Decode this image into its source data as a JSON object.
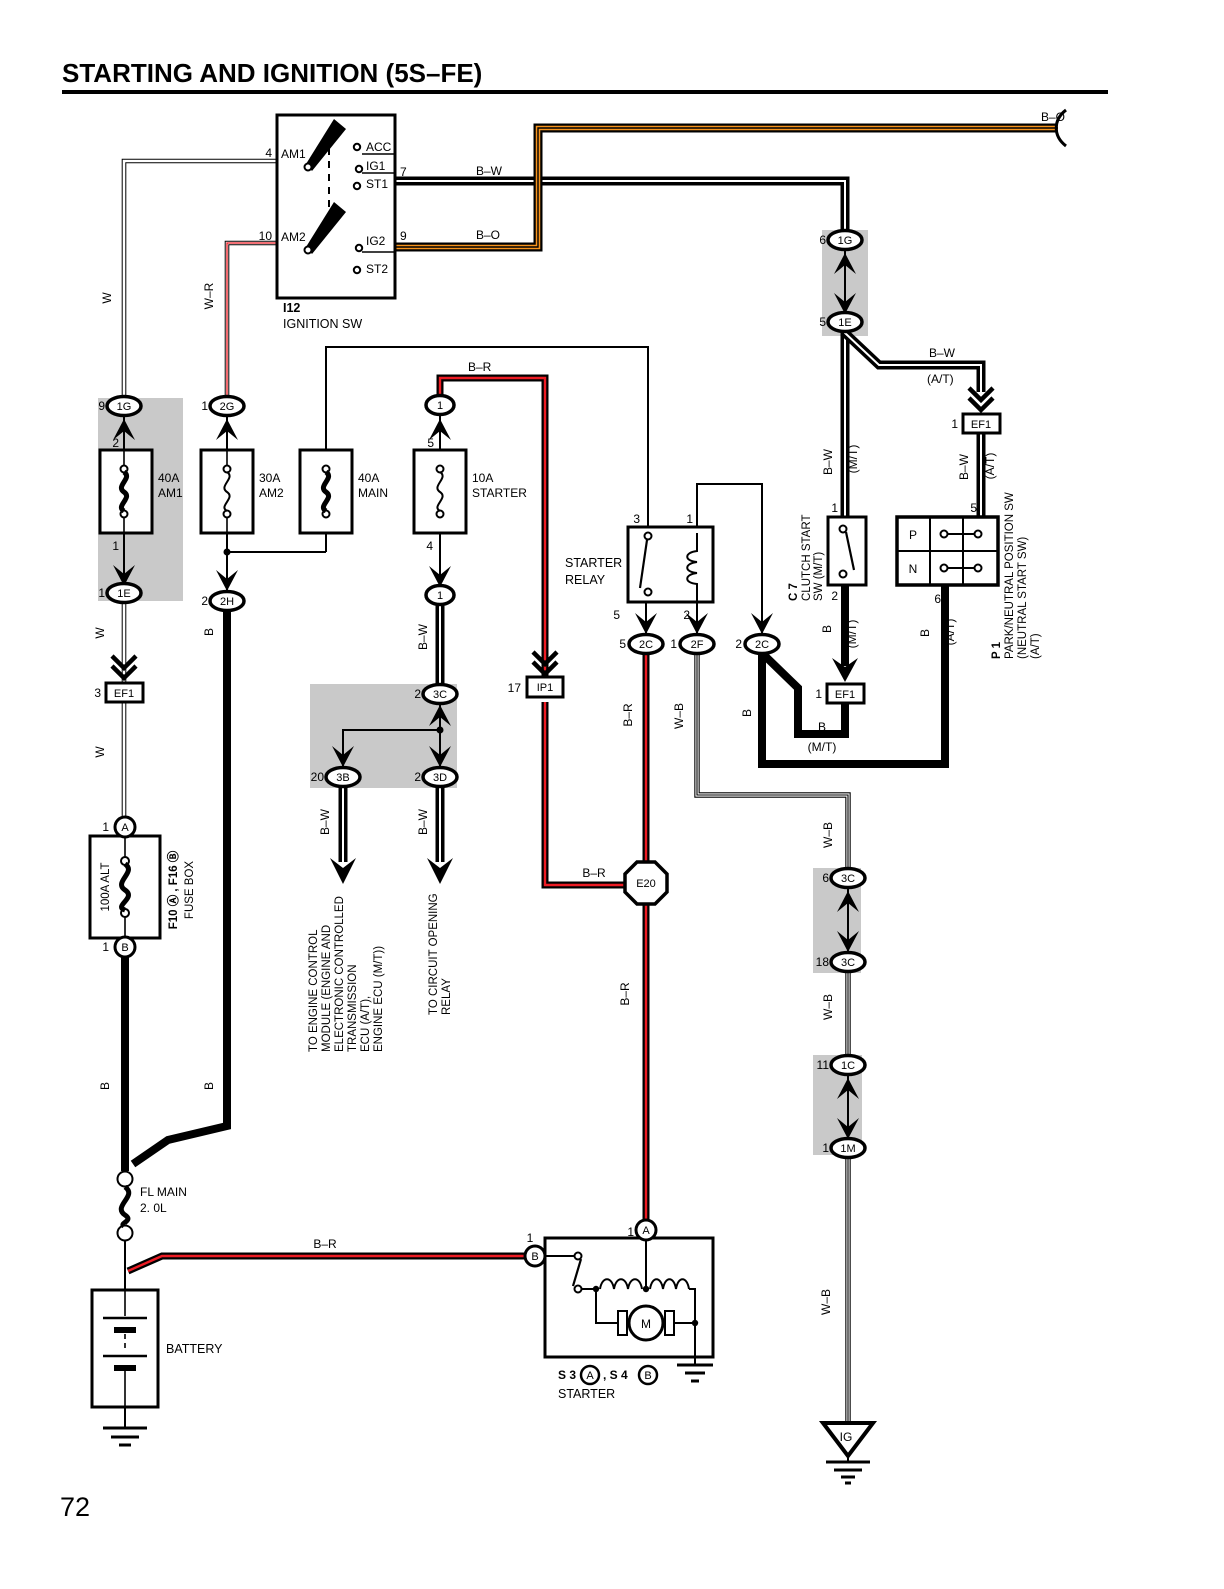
{
  "title": "STARTING AND IGNITION (5S–FE)",
  "page_number": "72",
  "colors": {
    "wire_orange": "#f7941d",
    "wire_red": "#ed1c24",
    "shade_gray": "#c9c9c9"
  },
  "ignition_switch": {
    "id": "I12",
    "name": "IGNITION SW",
    "am1": "AM1",
    "am2": "AM2",
    "acc": "ACC",
    "ig1": "IG1",
    "st1": "ST1",
    "ig2": "IG2",
    "st2": "ST2"
  },
  "labels": {
    "w": "W",
    "wr": "W–R",
    "bw": "B–W",
    "bo": "B–O",
    "br": "B–R",
    "wb": "W–B",
    "b": "B",
    "mt": "(M/T)",
    "at": "(A/T)"
  },
  "pins": {
    "n1": "1",
    "n2": "2",
    "n3": "3",
    "n4": "4",
    "n5": "5",
    "n6": "6",
    "n7": "7",
    "n9": "9",
    "n10": "10",
    "n11": "11",
    "n17": "17",
    "n18": "18",
    "n20": "20"
  },
  "connectors": {
    "c1g": "1G",
    "c2g": "2G",
    "c1e": "1E",
    "c2h": "2H",
    "c3b": "3B",
    "c3c": "3C",
    "c3d": "3D",
    "c2c": "2C",
    "c2f": "2F",
    "c1c": "1C",
    "c1m": "1M",
    "e20": "E20",
    "ef1": "EF1",
    "ip1": "IP1",
    "n1": "1",
    "a": "A",
    "b": "B"
  },
  "fuses": {
    "am1_rating": "40A",
    "am1_name": "AM1",
    "am2_rating": "30A",
    "am2_name": "AM2",
    "main_rating": "40A",
    "main_name": "MAIN",
    "starter_rating": "10A",
    "starter_name": "STARTER",
    "alt": "100A ALT",
    "fl_main_line1": "FL MAIN",
    "fl_main_line2": "2. 0L"
  },
  "fuse_box": {
    "label_ids": "F10 Ⓐ , F16 Ⓑ",
    "label_name": "FUSE BOX"
  },
  "starter_relay": {
    "line1": "STARTER",
    "line2": "RELAY"
  },
  "clutch_switch": {
    "id": "C 7",
    "line1": "CLUTCH START",
    "line2": "SW (M/T)"
  },
  "neutral_switch": {
    "id": "P 1",
    "line1": "PARK/NEUTRAL POSITION SW",
    "line2": "(NEUTRAL START SW)",
    "line3": "(A/T)",
    "p": "P",
    "n": "N"
  },
  "battery": {
    "label": "BATTERY"
  },
  "starter": {
    "s3": "S 3",
    "a": "A",
    "s4": ", S 4",
    "b": "B",
    "name": "STARTER",
    "motor": "M"
  },
  "notes": {
    "ecm_l1": "TO ENGINE CONTROL",
    "ecm_l2": "MODULE (ENGINE AND",
    "ecm_l3": "ELECTRONIC CONTROLLED",
    "ecm_l4": "TRANSMISSION",
    "ecm_l5": "ECU (A/T),",
    "ecm_l6": "ENGINE ECU (M/T))",
    "cor_l1": "TO CIRCUIT OPENING",
    "cor_l2": "RELAY"
  },
  "ground": {
    "ig": "IG"
  }
}
